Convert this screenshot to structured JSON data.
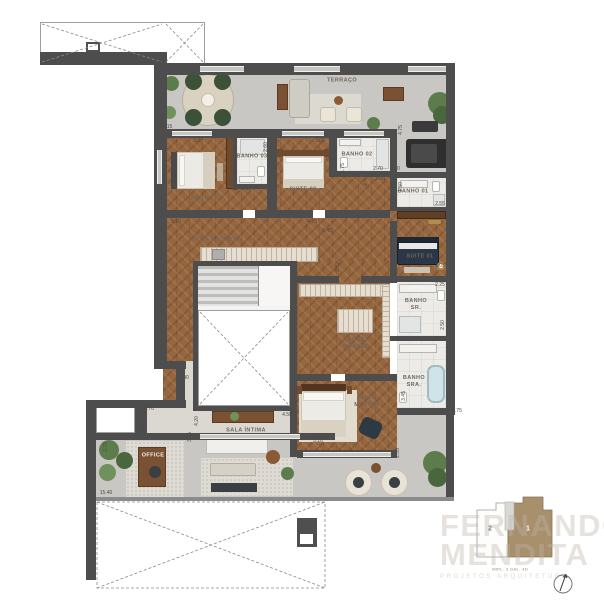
{
  "palette": {
    "wall": "#4d4d4d",
    "wood_floor": "#96663f",
    "terrace_floor": "#c8c7c3",
    "bath_floor": "#ecebe7",
    "accent_brown": "#7b5134",
    "plant_green": "#5d7c4c",
    "navy_bed": "#2b3646",
    "keyplan_highlight": "#a8906c"
  },
  "rooms": [
    {
      "name": "TERRAÇO",
      "x": 342,
      "y": 81
    },
    {
      "name": "SUITE 03",
      "x": 204,
      "y": 199
    },
    {
      "name": "BANHO 03",
      "x": 252,
      "y": 157
    },
    {
      "name": "SUITE 02",
      "x": 303,
      "y": 190
    },
    {
      "name": "BANHO 02",
      "x": 357,
      "y": 155
    },
    {
      "name": "BANHO 01",
      "x": 413,
      "y": 192
    },
    {
      "name": "SUITE 01",
      "x": 420,
      "y": 257
    },
    {
      "name": "BANHO\nSR.",
      "x": 416,
      "y": 305
    },
    {
      "name": "BANHO\nSRA.",
      "x": 414,
      "y": 382
    },
    {
      "name": "COPA NOTURNA",
      "x": 217,
      "y": 240
    },
    {
      "name": "CLOSET\nMASTER",
      "x": 356,
      "y": 344
    },
    {
      "name": "SUITE\nMASTER",
      "x": 367,
      "y": 402
    },
    {
      "name": "SALA ÍNTIMA",
      "x": 246,
      "y": 431
    },
    {
      "name": "OFFICE",
      "x": 153,
      "y": 456,
      "light": true
    }
  ],
  "dimensions": [
    {
      "text": "15.15",
      "x": 166,
      "y": 127
    },
    {
      "text": "3.25",
      "x": 198,
      "y": 141
    },
    {
      "text": "2.60",
      "x": 266,
      "y": 147,
      "vertical": true
    },
    {
      "text": "1.60",
      "x": 246,
      "y": 189
    },
    {
      "text": "5.10",
      "x": 176,
      "y": 222
    },
    {
      "text": "3.02",
      "x": 320,
      "y": 141
    },
    {
      "text": "1.75",
      "x": 343,
      "y": 168,
      "vertical": true
    },
    {
      "text": "4.75",
      "x": 312,
      "y": 222
    },
    {
      "text": "8.45",
      "x": 327,
      "y": 231
    },
    {
      "text": "4.75",
      "x": 401,
      "y": 130,
      "vertical": true
    },
    {
      "text": "2.70",
      "x": 378,
      "y": 169
    },
    {
      "text": "3.60",
      "x": 395,
      "y": 169
    },
    {
      "text": "1.00",
      "x": 380,
      "y": 179
    },
    {
      "text": "2.40",
      "x": 366,
      "y": 181,
      "vertical": true
    },
    {
      "text": "1.50",
      "x": 401,
      "y": 187,
      "vertical": true
    },
    {
      "text": "2.55",
      "x": 440,
      "y": 204
    },
    {
      "text": "3.05",
      "x": 440,
      "y": 266
    },
    {
      "text": "2.25",
      "x": 440,
      "y": 285
    },
    {
      "text": "2.50",
      "x": 443,
      "y": 325,
      "vertical": true
    },
    {
      "text": "2.25",
      "x": 440,
      "y": 339
    },
    {
      "text": "3.45",
      "x": 404,
      "y": 396,
      "vertical": true
    },
    {
      "text": "0.75",
      "x": 457,
      "y": 411
    },
    {
      "text": "2.35",
      "x": 398,
      "y": 453,
      "vertical": true
    },
    {
      "text": "5.10",
      "x": 318,
      "y": 441
    },
    {
      "text": "4.50",
      "x": 287,
      "y": 415
    },
    {
      "text": "4.20",
      "x": 197,
      "y": 421,
      "vertical": true
    },
    {
      "text": "3.15",
      "x": 190,
      "y": 437,
      "vertical": true
    },
    {
      "text": "1.40",
      "x": 184,
      "y": 378
    },
    {
      "text": "1.40",
      "x": 304,
      "y": 278
    },
    {
      "text": "2.62",
      "x": 338,
      "y": 267,
      "vertical": true
    },
    {
      "text": "2.70",
      "x": 149,
      "y": 409
    },
    {
      "text": "1.50",
      "x": 143,
      "y": 428,
      "vertical": true
    },
    {
      "text": "2.75",
      "x": 106,
      "y": 447,
      "vertical": true
    },
    {
      "text": "15.40",
      "x": 106,
      "y": 493
    }
  ],
  "keyplan": {
    "unit_highlighted": "1",
    "unit_other": "2",
    "caption": "IMPL. 3 GAL. 4D"
  },
  "watermark": {
    "line1": "FERNANDO",
    "line2": "MENDITA",
    "line3": "PROJETOS ARQUITETURA"
  }
}
